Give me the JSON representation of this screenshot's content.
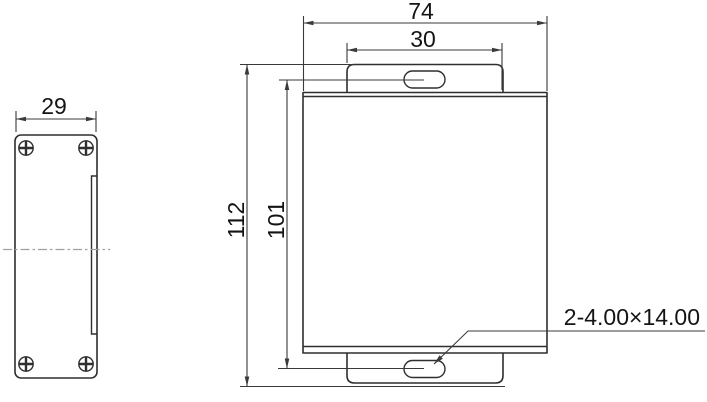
{
  "drawing": {
    "title": "enclosure-dimension-drawing",
    "side_view": {
      "width_dim": "29"
    },
    "front_view": {
      "overall_width_dim": "74",
      "tab_width_dim": "30",
      "overall_height_dim": "112",
      "slot_spacing_dim": "101",
      "slot_note": "2-4.00×14.00"
    },
    "colors": {
      "line": "#2f2f2f",
      "dimension": "#3a3a3a",
      "centerline": "#a0a0a0",
      "text": "#141414",
      "background": "#ffffff"
    }
  }
}
